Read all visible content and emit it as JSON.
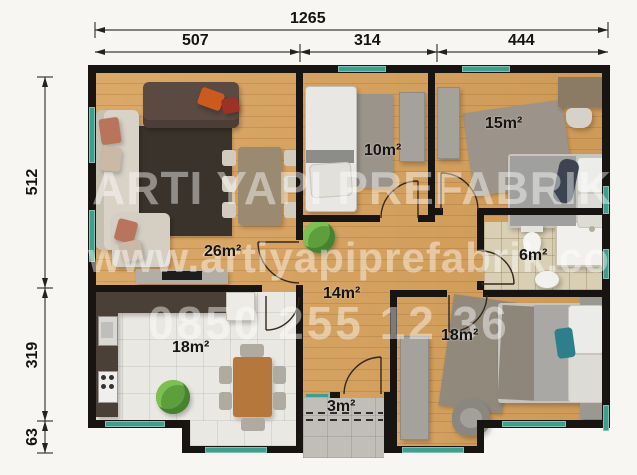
{
  "drawing": {
    "type": "architectural floor plan (prefabricated house, top-down furnished view)",
    "units": "cm"
  },
  "watermark": {
    "line1": "ARTI YAPI PREFABRIK",
    "line2": "www.artiyapiprefabrik.com",
    "line3": "0850 255 12 36"
  },
  "dimensions": {
    "top_total": "1265",
    "top_segments": [
      "507",
      "314",
      "444"
    ],
    "left_segments": [
      "512",
      "319",
      "63"
    ]
  },
  "rooms": {
    "living": "26m²",
    "bedroom_small": "10m²",
    "bedroom_top_right": "15m²",
    "bathroom": "6m²",
    "hall": "14m²",
    "kitchen": "18m²",
    "bedroom_bottom_right": "18m²",
    "entry": "3m²"
  },
  "colors": {
    "wall": "#181411",
    "window": "#3f9e8d",
    "wood_floor": "#d8a25c",
    "kitchen_tile": "#eae8e3",
    "bath_tile": "#d9cfb5",
    "entry_concrete": "#c1beb8",
    "paper": "#f7f6f3"
  }
}
